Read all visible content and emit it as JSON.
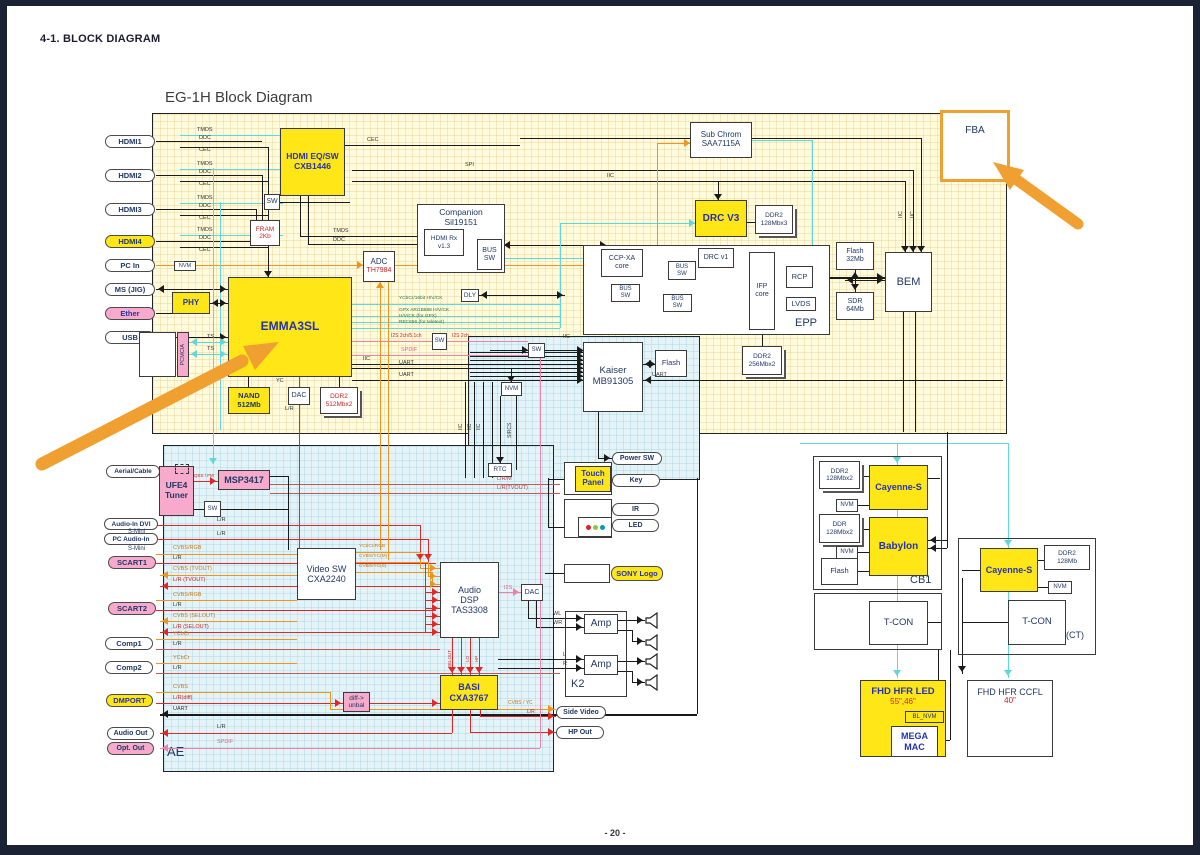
{
  "page": {
    "header": "4-1. BLOCK DIAGRAM",
    "title": "EG-1H Block Diagram",
    "page_number": "- 20 -"
  },
  "colors": {
    "board_yellow": "#FFFBDC",
    "board_blue": "#E4F3F7",
    "chip_yellow": "#FFE616",
    "chip_pink": "#F7AACB",
    "accent_orange": "#F0A030",
    "wire_cyan": "#5FD8DC",
    "wire_orange": "#F0941E",
    "wire_red": "#E02828",
    "wire_pink": "#F080A8",
    "text_navy": "#1f3864",
    "text_blue": "#2333B0",
    "text_red": "#D42020"
  },
  "ports": {
    "hdmi1": "HDMI1",
    "hdmi2": "HDMI2",
    "hdmi3": "HDMI3",
    "hdmi4": "HDMI4",
    "pc_in": "PC In",
    "ms_jig": "MS (JIG)",
    "ether": "Ether",
    "usb": "USB",
    "aerial": "Aerial/Cable",
    "audio_in_dvi": "Audio-In DVI",
    "pc_audio_in": "PC Audio-In",
    "s_mini": "S-Mini",
    "scart1": "SCART1",
    "scart2": "SCART2",
    "comp1": "Comp1",
    "comp2": "Comp2",
    "dmport": "DMPORT",
    "audio_out": "Audio Out",
    "opt_out": "Opt. Out",
    "power_sw": "Power SW",
    "key": "Key",
    "ir": "IR",
    "led": "LED",
    "sony_logo": "SONY Logo",
    "side_video": "Side Video",
    "hp_out": "HP Out"
  },
  "blocks": {
    "hdmi_eq": "HDMI EQ/SW\nCXB1446",
    "sw": "SW",
    "fram": "FRAM\n2Kb",
    "companion": "Companion\nSil19151",
    "hdmi_rx": "HDMI Rx\nv1.3",
    "bus_sw": "BUS\nSW",
    "dly": "DLY",
    "adc": "ADC",
    "adc_part": "TH7984",
    "sub_chrom": "Sub Chrom\nSAA7115A",
    "drc_v3": "DRC V3",
    "ddr2_128x3": "DDR2\n128Mbx3",
    "ccp_xa": "CCP-XA\ncore",
    "drc_v1": "DRC v1",
    "ifp": "IFP\ncore",
    "rcp": "RCP",
    "lvds": "LVDS",
    "ddr2_256x2": "DDR2\n256Mbx2",
    "flash_32": "Flash\n32Mb",
    "sdr_64": "SDR\n64Mb",
    "bem": "BEM",
    "emma": "EMMA3SL",
    "pcmcia": "PCMCIA",
    "phy": "PHY",
    "nand": "NAND\n512Mb",
    "dac": "DAC",
    "ddr2_512x2": "DDR2\n512Mbx2",
    "nvm": "NVM",
    "rtc": "RTC",
    "kaiser": "Kaiser\nMB91305",
    "flash": "Flash",
    "ufe4": "UFE4\nTuner",
    "msp": "MSP3417",
    "video_sw": "Video SW\nCXA2240",
    "audio_dsp": "Audio\nDSP\nTAS3308",
    "basi": "BASI\nCXA3767",
    "diff_unbal": "diff->\nunbal",
    "touch_panel": "Touch\nPanel",
    "amp": "Amp",
    "ddr2_128x2": "DDR2\n128Mbx2",
    "cayenne": "Cayenne-S",
    "ddr_128x2": "DDR\n128Mbx2",
    "babylon": "Babylon",
    "tcon": "T-CON",
    "ddr2_128": "DDR2\n128Mb",
    "fhd_led": "FHD HFR LED",
    "fhd_led_size": "55\",46\"",
    "bl_nvm": "BL_NVM",
    "mega_mac": "MEGA\nMAC",
    "fhd_ccfl": "FHD HFR CCFL",
    "fhd_ccfl_size": "40\""
  },
  "labels": {
    "epp": "EPP",
    "ae": "AE",
    "k2": "K2",
    "cb1": "CB1",
    "ct": "(CT)",
    "fba": "FBA"
  },
  "signals": {
    "tmds": "TMDS",
    "ddc": "DDC",
    "cec": "CEC",
    "spi": "SPI",
    "iic": "IIC",
    "ts": "TS",
    "uart": "UART",
    "nvm": "NVM",
    "ycbcr16": "YCbCr/16bit H/V/CK",
    "gpx": "GPX ARGB888 H/V/CK",
    "hvck_gpx": "H/V/CK (for GPX)",
    "rec656": "REC656 (for teletext)",
    "i2s_2ch51": "I2S 2ch/5.1ch",
    "i2s_2ch": "I2S 2ch",
    "i2s": "I2S",
    "spdif": "SPDIF",
    "sircs": "SIRCS",
    "qss_fm": "QSS / FM",
    "lrm": "L/R/M",
    "lr_tvout": "L/R(TVOUT)",
    "lr": "L/R",
    "cvbs_rgb": "CVBS/RGB",
    "cvbs_tvout": "CVBS (TVOUT)",
    "lr_tvout2": "L/R (TVOUT)",
    "cvbs_selout": "CVBS (SELOUT)",
    "lr_selout": "L/R (SELOUT)",
    "ycbcr": "YCbCr",
    "cvbs": "CVBS",
    "lr_diff": "L/R(diff)",
    "ycbcr_rgb": "YCbCr/RGB",
    "cvbs_ycm": "CVBS/YC(M)",
    "cvbs_ycs": "CVBS/YC(S)",
    "wl": "WL",
    "wr": "WR",
    "l": "L",
    "r": "R",
    "cvbs_yc": "CVBS / YC",
    "yc": "YC",
    "selout": "SELOUT",
    "lo": "LO",
    "hp": "HP"
  }
}
